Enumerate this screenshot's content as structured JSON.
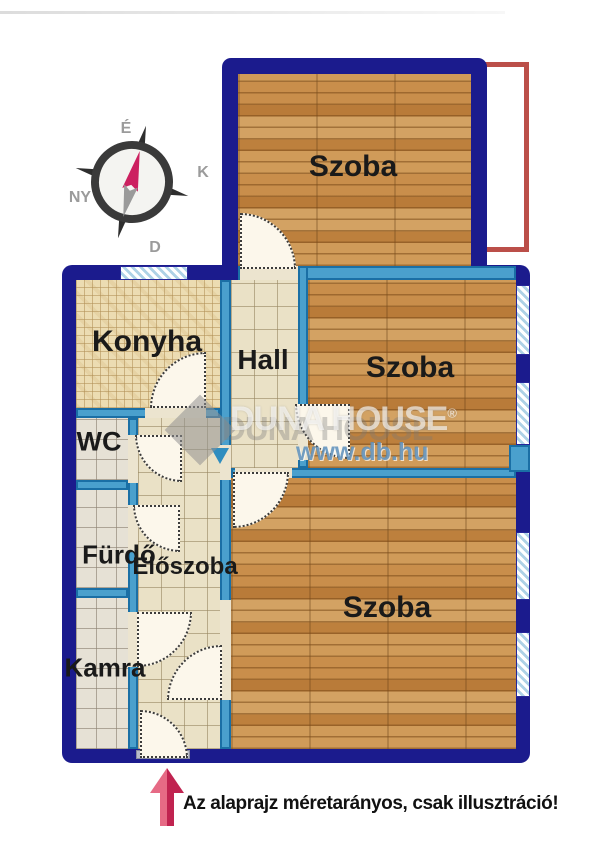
{
  "plan": {
    "rooms": [
      {
        "id": "szoba-top",
        "label": "Szoba"
      },
      {
        "id": "konyha",
        "label": "Konyha"
      },
      {
        "id": "hall",
        "label": "Hall"
      },
      {
        "id": "szoba-middle",
        "label": "Szoba"
      },
      {
        "id": "wc",
        "label": "WC"
      },
      {
        "id": "furdo",
        "label": "Fürdő"
      },
      {
        "id": "eloszoba",
        "label": "Előszoba"
      },
      {
        "id": "kamra",
        "label": "Kamra"
      },
      {
        "id": "szoba-bottom",
        "label": "Szoba"
      }
    ],
    "compass": {
      "north": "É",
      "east": "K",
      "south": "D",
      "west": "NY"
    },
    "caption": "Az alaprajz méretarányos, csak illusztráció!",
    "watermark": {
      "brand": "DUNA HOUSE",
      "reg": "®",
      "url": "www.db.hu"
    },
    "colors": {
      "outer_wall": "#1b1b8d",
      "inner_wall": "#4aa0cd",
      "balcony_outline": "#bb4f49",
      "entrance_arrow": "#c02350",
      "wood_floor": "#c8904f"
    }
  }
}
